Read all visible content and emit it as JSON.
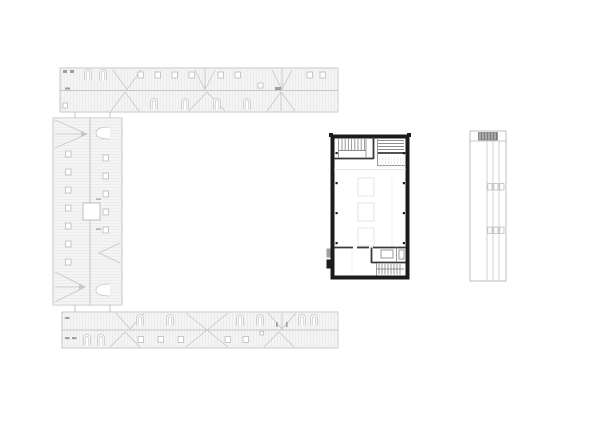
{
  "document": {
    "type": "architectural-site-plan",
    "sheet_background": "#ffffff",
    "visible_text": ""
  },
  "colors": {
    "context_fill": "#f4f4f3",
    "context_stroke": "#b5b9bc",
    "context_hatch": "#e7e9ea",
    "context_detail": "#c3c7ca",
    "focus_wall": "#1b1b1b",
    "focus_partition": "#3a3a3a",
    "focus_thin": "#8f8f8f",
    "annex_dark_fill": "#a8a8a8"
  },
  "buildings": [
    {
      "id": "north-wing",
      "name": "north wing roof plan"
    },
    {
      "id": "west-wing",
      "name": "west wing roof plan"
    },
    {
      "id": "south-wing",
      "name": "south wing roof plan"
    },
    {
      "id": "main-building",
      "name": "main building floor plan (highlighted with black walls)"
    },
    {
      "id": "east-annex",
      "name": "east annex roof plan"
    }
  ]
}
